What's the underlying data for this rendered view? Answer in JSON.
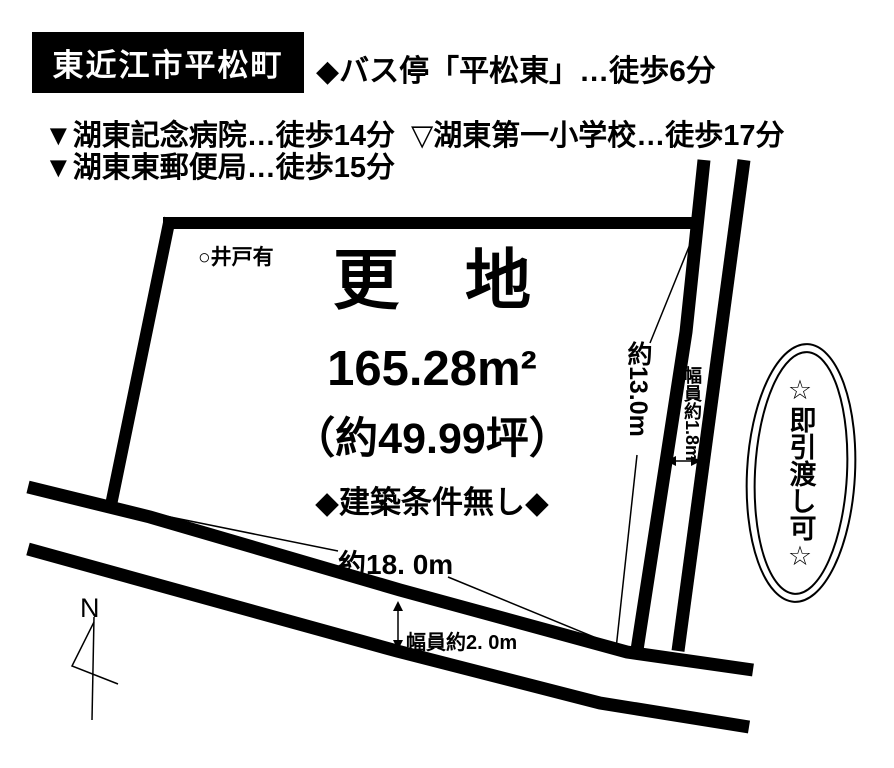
{
  "header": {
    "location": "東近江市平松町",
    "bus_access": "◆バス停「平松東」…徒歩6分",
    "facilities": [
      "▼湖東記念病院…徒歩14分",
      "▽湖東第一小学校…徒歩17分",
      "▼湖東東郵便局…徒歩15分"
    ]
  },
  "plot": {
    "well_note": "○井戸有",
    "status": "更　地",
    "area_m2": "165.28m²",
    "area_tsubo": "（約49.99坪）",
    "condition": "◆建築条件無し◆"
  },
  "dimensions": {
    "east_boundary": "約13.0m",
    "east_road_width": "幅員約1.8m",
    "south_boundary": "約18. 0m",
    "south_road_width": "幅員約2. 0m"
  },
  "badge": {
    "text": "☆即引渡し可☆"
  },
  "compass": {
    "label": "N"
  },
  "colors": {
    "ink": "#000000",
    "paper": "#ffffff",
    "title_box_bg": "#000000",
    "title_box_text": "#ffffff"
  }
}
